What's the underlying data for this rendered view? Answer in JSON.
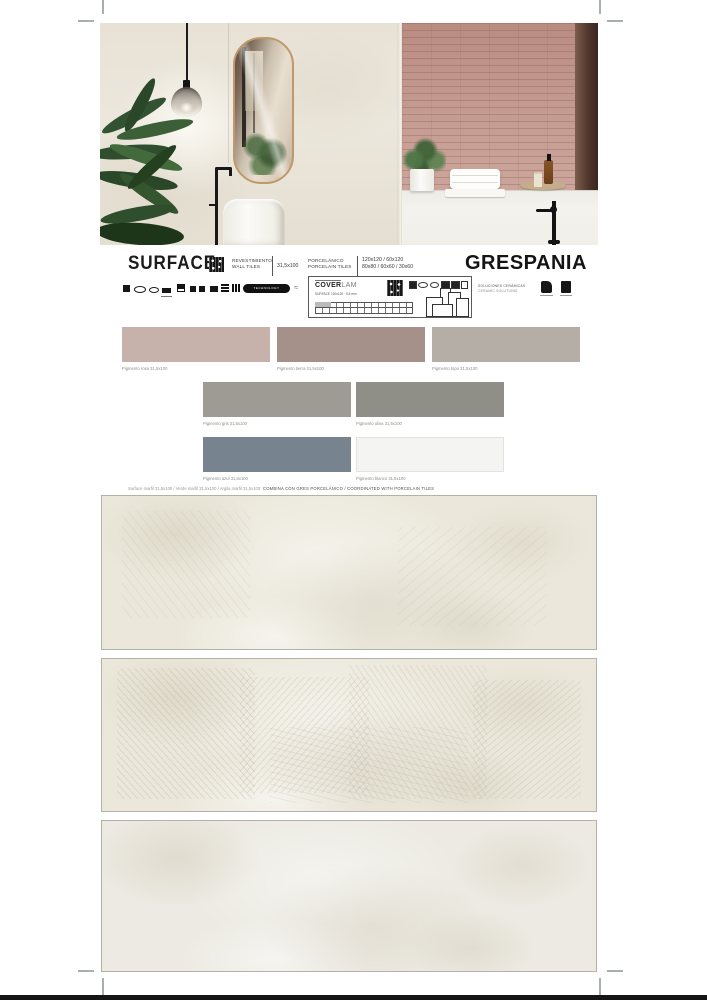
{
  "header": {
    "title": "SURFACE",
    "category_es": "REVESTIMIENTO",
    "category_en": "WALL TILES",
    "wall_size": "31,5x100",
    "material_es": "PORCELÁNICO",
    "material_en": "PORCELAIN TILES",
    "porcelain_sizes_line1": "120x120 / 60x120",
    "porcelain_sizes_line2": "80x80 / 60x60 / 30x60",
    "badge_label": "TECHNOLOGY"
  },
  "brand": {
    "name": "GRESPANIA",
    "tagline_line1": "SOLUCIONES CERÁMICAS",
    "tagline_line2": "CERAMIC SOLUTIONS"
  },
  "coverlam": {
    "brand_bold": "COVER",
    "brand_light": "LAM",
    "subtitle": "SURFACE 120x120 · 5,6 mm"
  },
  "swatches": {
    "items": [
      {
        "label": "Pigmento rosa 31,5x100",
        "color": "#c6b1ab"
      },
      {
        "label": "Pigmento tierra 31,5x100",
        "color": "#a5918a"
      },
      {
        "label": "Pigmento topo 31,5x100",
        "color": "#b5aea7"
      },
      {
        "label": "Pigmento gris 31,5x100",
        "color": "#9e9a94"
      },
      {
        "label": "Pigmento oliva 31,5x100",
        "color": "#8f8f88"
      },
      {
        "label": "Pigmento azul 31,5x100",
        "color": "#77838f"
      },
      {
        "label": "Pigmento blanco 31,5x100",
        "color": "#f4f4f2"
      }
    ]
  },
  "caption": {
    "combinations": "Surface marfil 31,5x100 / Verde marfil 31,5x100 / Argila marfil 31,5x100",
    "coordinated": "COMBINA CON GRES PORCELÁNICO / COORDINATED WITH PORCELAIN TILES"
  },
  "colors": {
    "tile_base": "#ebe8db",
    "pink_wall": "#c49a90",
    "mirror_frame": "#bf996a",
    "accent_black": "#151515"
  }
}
